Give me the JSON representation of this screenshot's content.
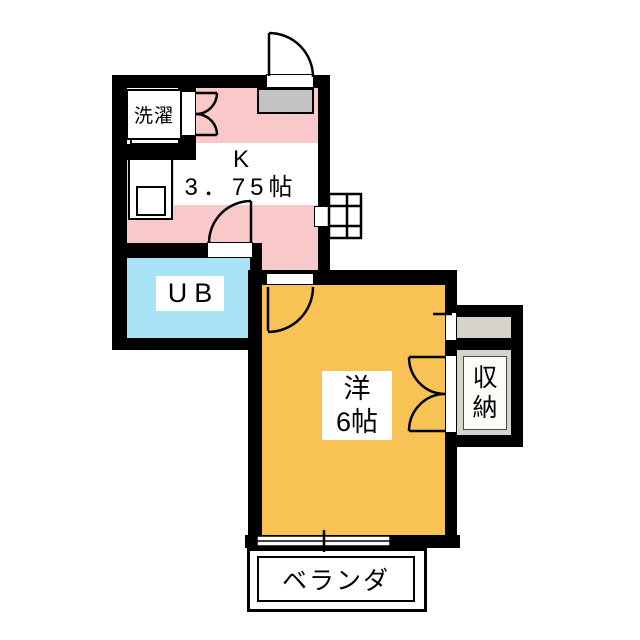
{
  "plan": {
    "type": "japanese-apartment-floor-plan",
    "labels": {
      "laundry": "洗濯",
      "kitchen_line1": "K",
      "kitchen_line2": "3．75帖",
      "unit_bath": "UB",
      "western_room_line1": "洋",
      "western_room_line2": "6帖",
      "storage_char1": "収",
      "storage_char2": "納",
      "veranda": "ベランダ"
    },
    "colors": {
      "wall": "#000000",
      "kitchen_fill": "#F9C9C9",
      "unit_bath_fill": "#ABE3F6",
      "western_room_fill": "#F9C254",
      "storage_fill": "#D6D3CA",
      "entrance_cabinet_fill": "#C3C3C3",
      "label_background": "#FFFFFF"
    }
  }
}
